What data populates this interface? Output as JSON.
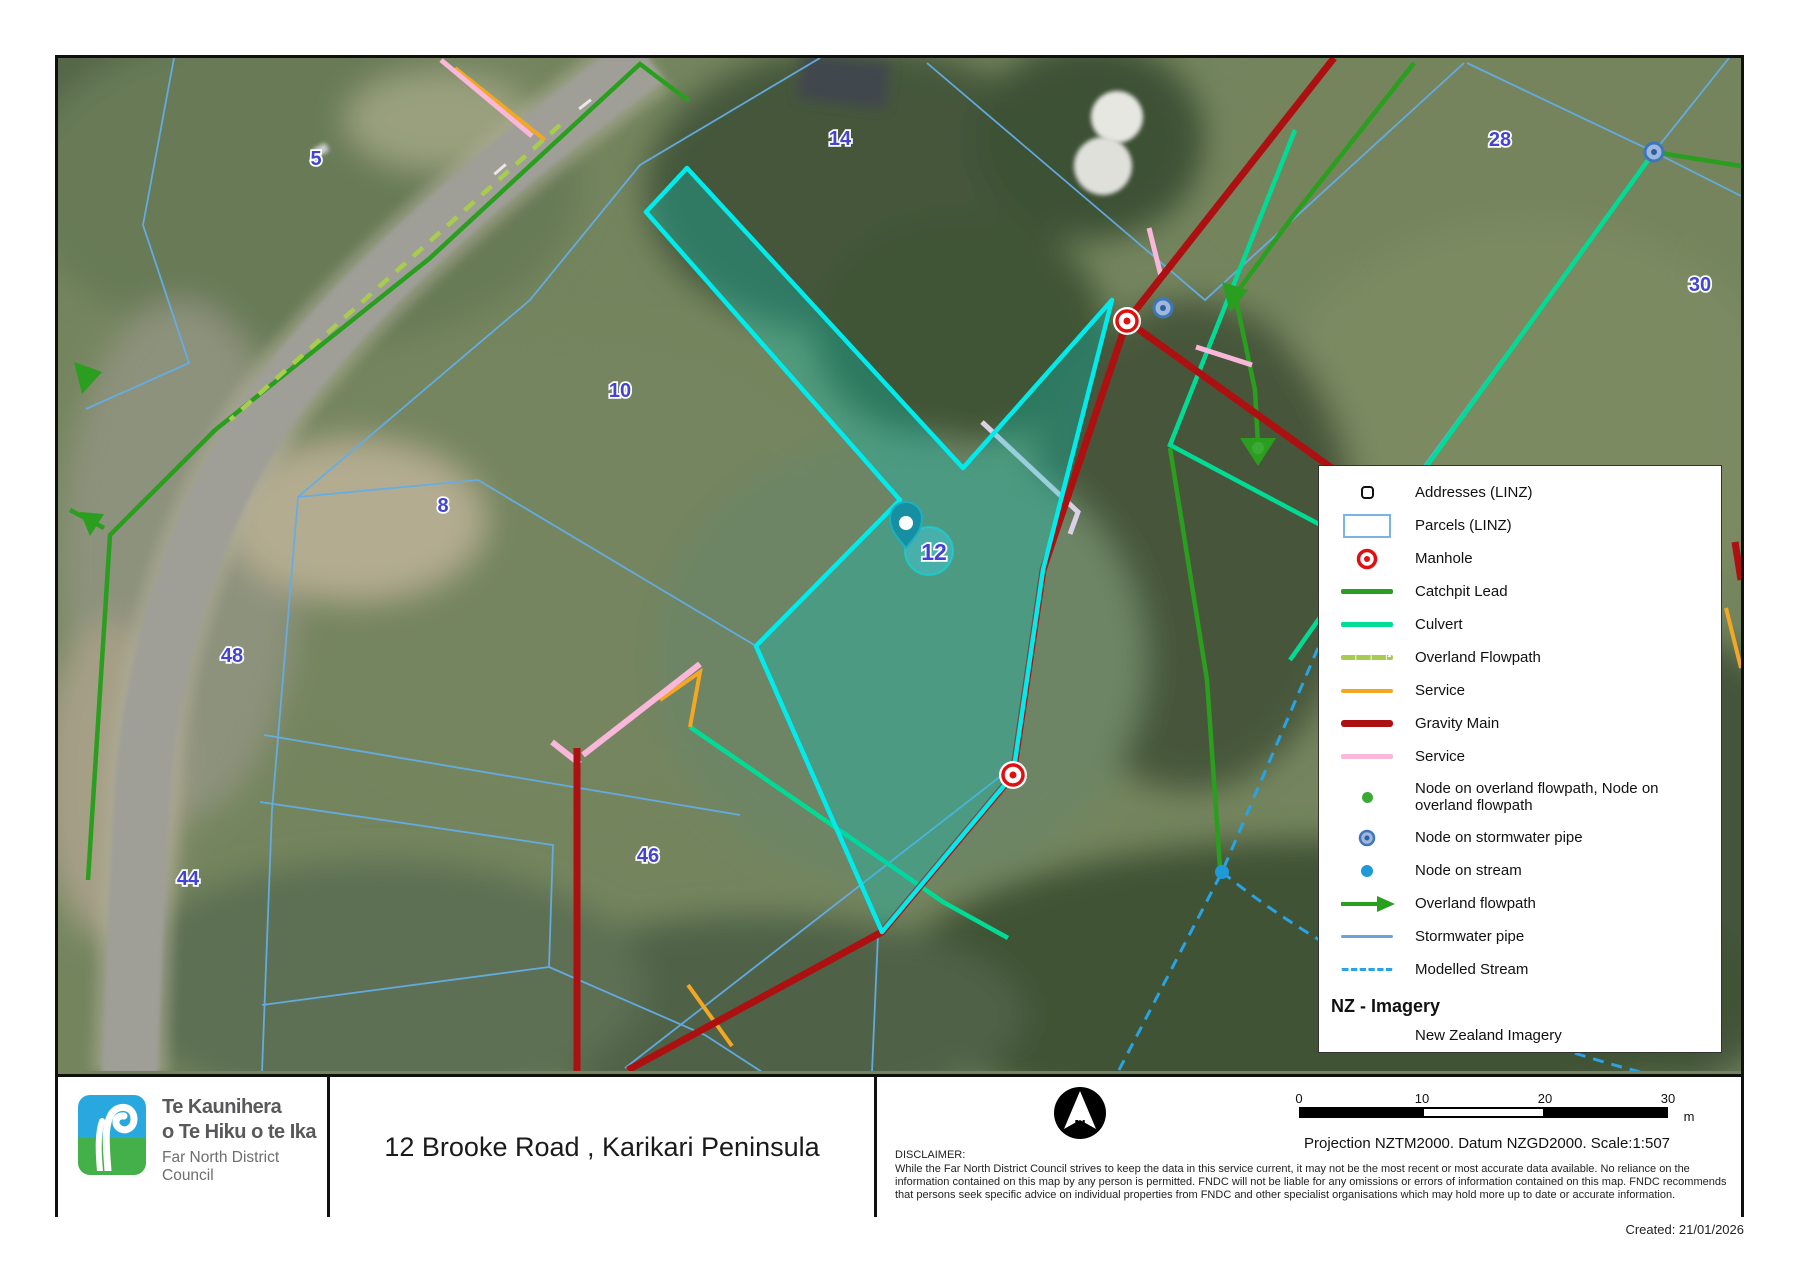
{
  "map": {
    "labels": [
      {
        "text": "5"
      },
      {
        "text": "14"
      },
      {
        "text": "28"
      },
      {
        "text": "30"
      },
      {
        "text": "10"
      },
      {
        "text": "8"
      },
      {
        "text": "48"
      },
      {
        "text": "44"
      },
      {
        "text": "46"
      },
      {
        "text": "12"
      }
    ],
    "selected_parcel": "12",
    "colors": {
      "selected_outline": "#00ecec",
      "gravity_main": "#ad1010",
      "catchpit_lead": "#2a9e1e",
      "culvert": "#00dc96",
      "service_orange": "#f4a722",
      "service_pink": "#f9b7d9",
      "parcel_line": "#63aee8",
      "modelled_stream": "#29a3e3",
      "label_blue": "#4343d6"
    }
  },
  "legend": {
    "items": [
      {
        "icon": "address-icon",
        "label": "Addresses (LINZ)"
      },
      {
        "icon": "parcel-swatch",
        "label": "Parcels (LINZ)"
      },
      {
        "icon": "manhole-icon",
        "label": "Manhole"
      },
      {
        "icon": "catchpit-lead-line",
        "label": "Catchpit Lead"
      },
      {
        "icon": "culvert-line",
        "label": "Culvert"
      },
      {
        "icon": "overland-flowpath-dashed-line",
        "label": "Overland Flowpath"
      },
      {
        "icon": "service-orange-line",
        "label": "Service"
      },
      {
        "icon": "gravity-main-line",
        "label": "Gravity Main"
      },
      {
        "icon": "service-pink-line",
        "label": "Service"
      },
      {
        "icon": "node-overland-flowpath-dot",
        "label": "Node on overland flowpath, Node on overland flowpath"
      },
      {
        "icon": "node-stormwater-pipe-dot",
        "label": "Node on stormwater pipe"
      },
      {
        "icon": "node-stream-dot",
        "label": "Node on stream"
      },
      {
        "icon": "overland-flowpath-arrow",
        "label": "Overland flowpath"
      },
      {
        "icon": "stormwater-pipe-line",
        "label": "Stormwater pipe"
      },
      {
        "icon": "modelled-stream-dashed-line",
        "label": "Modelled Stream"
      }
    ],
    "imagery_heading": "NZ - Imagery",
    "imagery_item": "New Zealand Imagery"
  },
  "footer": {
    "logo": {
      "line1": "Te Kaunihera",
      "line2": "o Te Hiku o te Ika",
      "line3": "Far North District Council"
    },
    "title": "12 Brooke Road , Karikari Peninsula",
    "north": "N",
    "scalebar": {
      "t0": "0",
      "t10": "10",
      "t20": "20",
      "t30": "30",
      "unit": "m"
    },
    "projection": "Projection NZTM2000. Datum NZGD2000.   Scale:1:507",
    "disclaimer_heading": "DISCLAIMER:",
    "disclaimer": "While the Far North District Council strives to keep the data in this service current, it may not be the most recent or most accurate data available. No reliance on the information contained on this map by any person is permitted. FNDC will not be liable for any omissions or errors of information contained on this map.  FNDC recommends that persons seek specific advice on individual properties from FNDC and other specialist organisations which may hold more up to date or accurate information.",
    "created": "Created: 21/01/2026"
  }
}
